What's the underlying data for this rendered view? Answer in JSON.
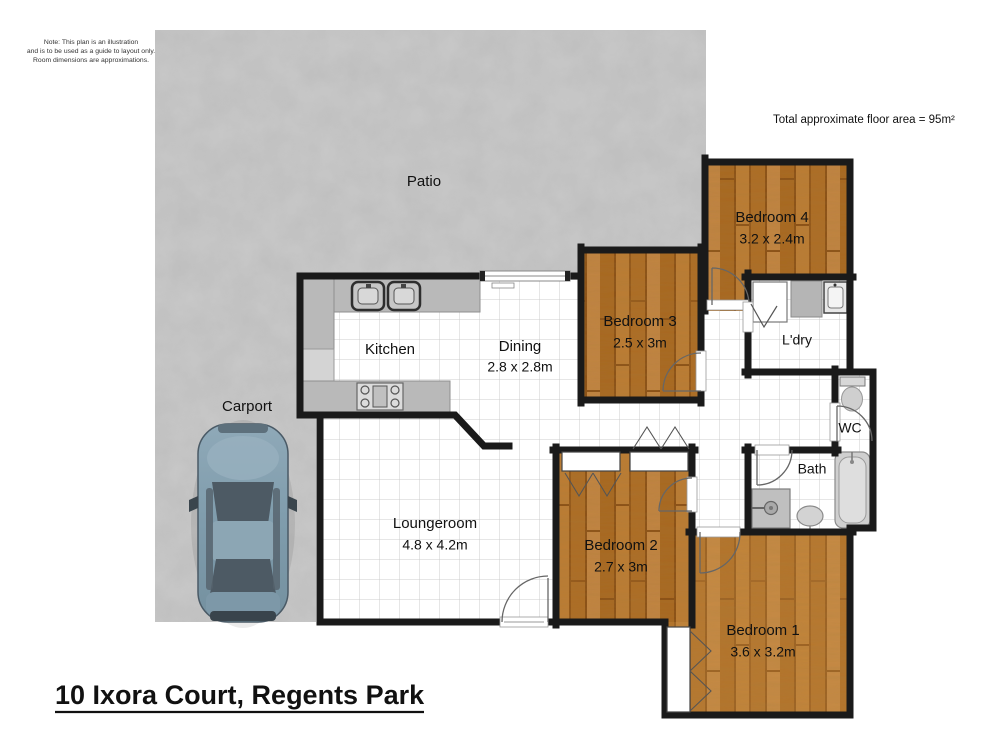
{
  "meta": {
    "note_line1": "Note: This plan is an illustration",
    "note_line2": "and is to be used as a guide to layout only.",
    "note_line3": "Room dimensions are approximations.",
    "floor_area": "Total approximate floor area = 95m²",
    "title": "10 Ixora Court, Regents Park"
  },
  "rooms": {
    "patio": {
      "name": "Patio"
    },
    "carport": {
      "name": "Carport"
    },
    "kitchen": {
      "name": "Kitchen"
    },
    "dining": {
      "name": "Dining",
      "dims": "2.8 x 2.8m"
    },
    "loungeroom": {
      "name": "Loungeroom",
      "dims": "4.8 x 4.2m"
    },
    "bedroom1": {
      "name": "Bedroom 1",
      "dims": "3.6 x 3.2m"
    },
    "bedroom2": {
      "name": "Bedroom 2",
      "dims": "2.7 x 3m"
    },
    "bedroom3": {
      "name": "Bedroom 3",
      "dims": "2.5 x 3m"
    },
    "bedroom4": {
      "name": "Bedroom 4",
      "dims": "3.2 x 2.4m"
    },
    "laundry": {
      "name": "L'dry"
    },
    "wc": {
      "name": "WC"
    },
    "bath": {
      "name": "Bath"
    }
  },
  "colors": {
    "wall": "#1a1a1a",
    "wood_floor": "#b06f28",
    "concrete": "#c9c9c9",
    "tile_line": "#cccccc",
    "counter": "#b9b9b9",
    "car_body": "#7f9cac"
  },
  "icons": {
    "car": "car-top-view-icon",
    "sink": "double-sink-icon",
    "stove": "cooktop-icon",
    "toilet": "toilet-icon",
    "bathtub": "bathtub-icon",
    "shower": "shower-icon",
    "basin": "basin-icon",
    "washer": "washing-machine-icon",
    "dryer": "dryer-icon",
    "laundry_tub": "laundry-tub-icon"
  }
}
